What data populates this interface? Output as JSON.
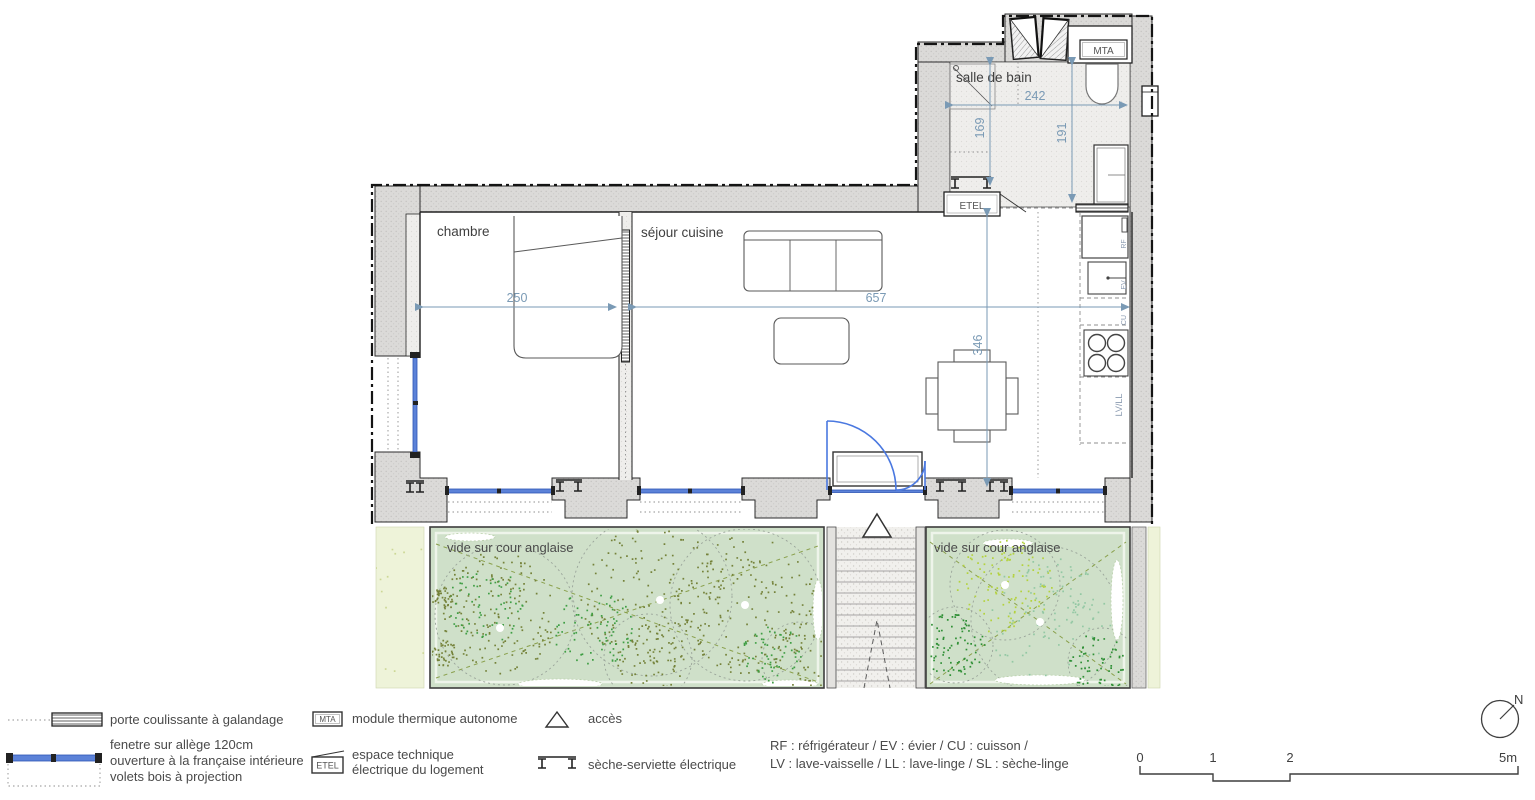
{
  "rooms": {
    "chambre": "chambre",
    "sejour": "séjour cuisine",
    "salle_de_bain": "salle de bain",
    "cour_gauche": "vide sur cour anglaise",
    "cour_droite": "vide sur cour anglaise"
  },
  "dimensions": {
    "chambre_width": "250",
    "sejour_width": "657",
    "sejour_depth": "346",
    "bain_width": "242",
    "bain_depth_left": "169",
    "bain_depth_right": "191"
  },
  "equipment": {
    "mta": "MTA",
    "etel": "ETEL",
    "rf": "RF",
    "ev": "EV",
    "cu": "CU",
    "lv_ll": "LV/LL"
  },
  "legend": {
    "porte_coulissante": "porte coulissante à galandage",
    "fenetre_line1": "fenetre sur allège 120cm",
    "fenetre_line2": "ouverture à la française intérieure",
    "fenetre_line3": "volets bois à projection",
    "mta_box": "MTA",
    "mta_label": "module thermique autonome",
    "etel_box": "ETEL",
    "etel_line1": "espace technique",
    "etel_line2": "électrique du logement",
    "acces": "accès",
    "seche_serviette": "sèche-serviette électrique",
    "abbrev_line1": "RF : réfrigérateur / EV : évier / CU : cuisson /",
    "abbrev_line2": "LV : lave-vaisselle / LL : lave-linge / SL : sèche-linge"
  },
  "scalebar": {
    "t0": "0",
    "t1": "1",
    "t2": "2",
    "t5": "5m",
    "north": "N"
  },
  "colors": {
    "dimension": "#7a9ab5",
    "window": "#5c82d8",
    "door": "#4a78e0",
    "wall_fill": "#dcdcdc",
    "courtyard": "#cfe0c9",
    "strip": "#eef3d9",
    "plant_olive": "#75823a",
    "plant_green": "#3f9e44",
    "plant_dark": "#2f8f35",
    "plant_lime": "#b4d23e",
    "plant_teal": "#93c8a4",
    "strip_dash": "#ccd795"
  }
}
